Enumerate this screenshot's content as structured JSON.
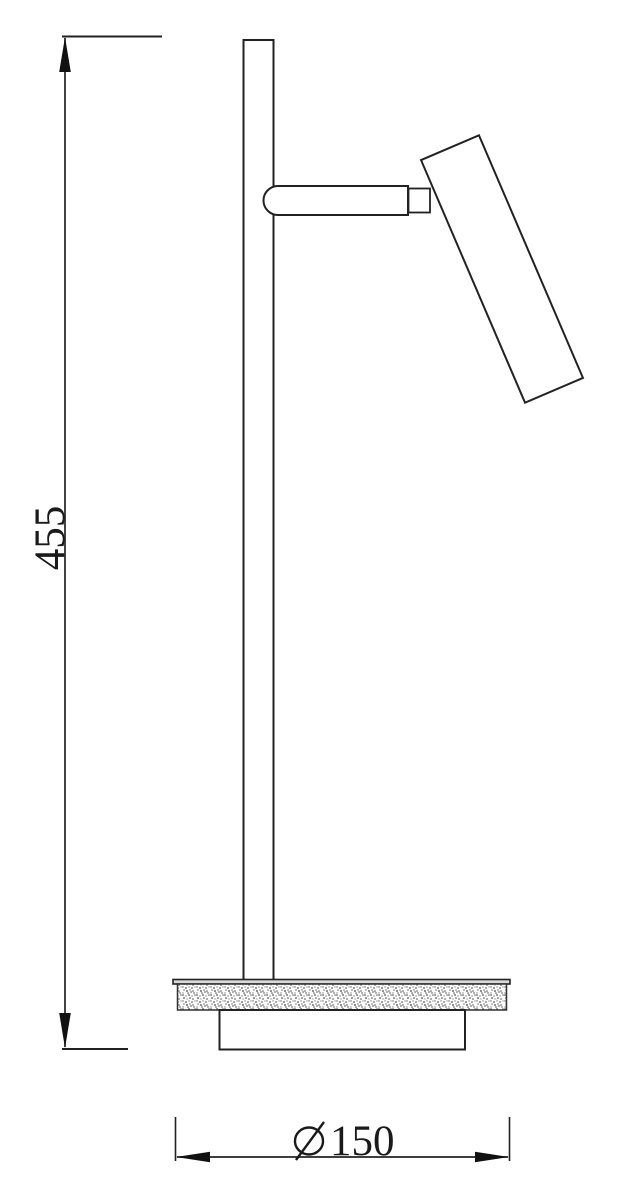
{
  "drawing": {
    "background": "#ffffff",
    "line_color": "#222222",
    "dimensions": {
      "height": {
        "value": "455",
        "orientation": "vertical"
      },
      "diameter": {
        "symbol": "⌀",
        "value": "150",
        "label": "⌀150",
        "orientation": "horizontal"
      }
    }
  }
}
